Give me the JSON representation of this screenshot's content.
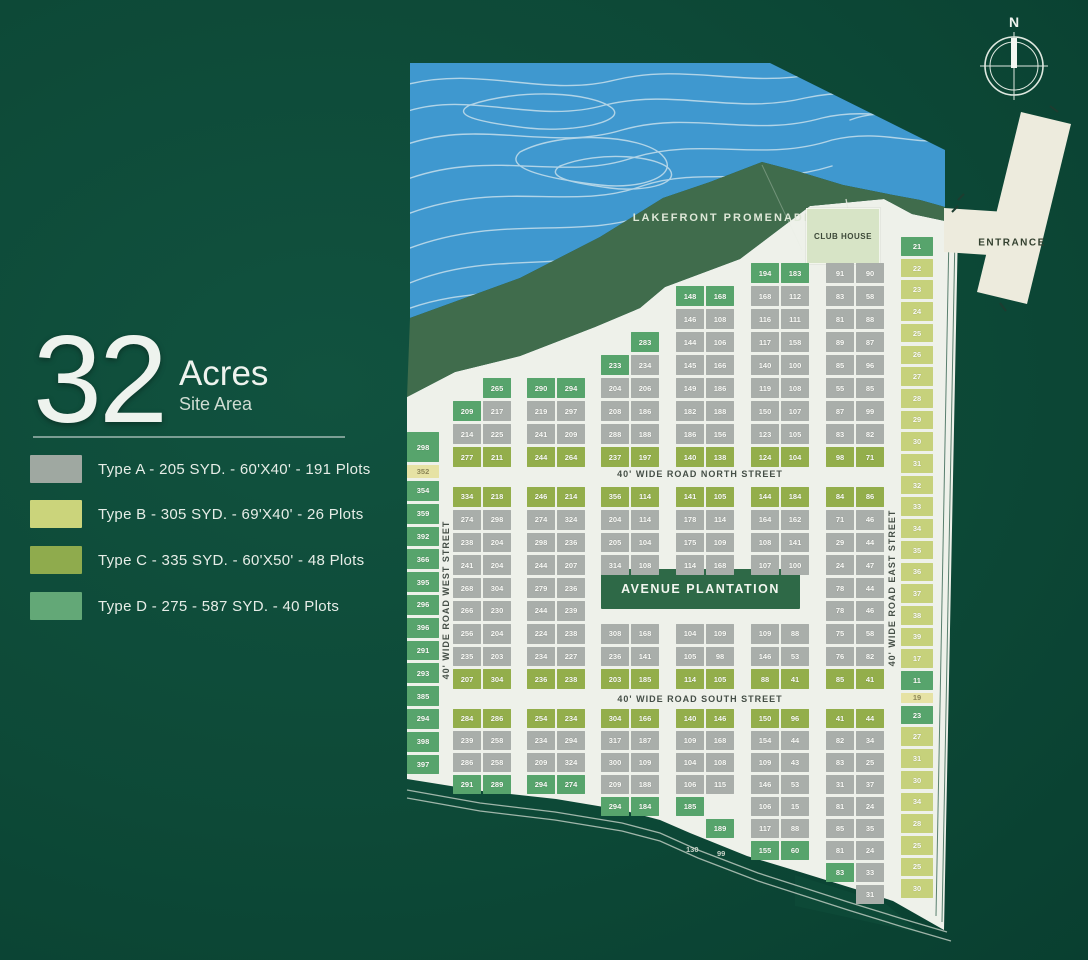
{
  "header": {
    "number": "32",
    "unit": "Acres",
    "subtitle": "Site Area"
  },
  "legend": {
    "items": [
      {
        "type": "A",
        "color": "#9fa8a1",
        "label": "Type A - 205 SYD. - 60'X40' - 191 Plots"
      },
      {
        "type": "B",
        "color": "#cbd47b",
        "label": "Type B - 305 SYD. - 69'X40' - 26 Plots"
      },
      {
        "type": "C",
        "color": "#8fab4d",
        "label": "Type C - 335 SYD. - 60'X50' - 48 Plots"
      },
      {
        "type": "D",
        "color": "#63a877",
        "label": "Type D - 275 - 587 SYD. - 40 Plots"
      }
    ]
  },
  "compass": {
    "label": "N"
  },
  "map": {
    "labels": {
      "promenade": "LAKEFRONT PROMENADE",
      "club_house": "CLUB HOUSE",
      "plantation": "AVENUE PLANTATION",
      "entrance": "ENTRANCE",
      "north_street": "40' WIDE ROAD NORTH STREET",
      "south_street": "40' WIDE ROAD SOUTH STREET",
      "west_street": "40' WIDE ROAD WEST STREET",
      "east_street": "40' WIDE ROAD EAST STREET"
    },
    "plot_colors": {
      "A": "#a9aeaa",
      "B": "#c6d17b",
      "C": "#93ae4b",
      "D": "#57a46c",
      "Y": "#e6e2a4"
    },
    "stray_labels": [
      {
        "x": 686,
        "y": 845,
        "t": "130"
      },
      {
        "x": 717,
        "y": 849,
        "t": "99"
      }
    ],
    "columns": [
      {
        "name": "west-plots",
        "x": 407,
        "w": 32,
        "top": 432,
        "cellH": 19.8,
        "cells": [
          {
            "t": "D",
            "n": "298",
            "h": 30
          },
          {
            "t": "Y",
            "n": "352",
            "h": 13
          },
          "D:354",
          "D:359",
          "D:392",
          "D:366",
          "D:395",
          "D:296",
          "D:396",
          "D:291",
          "D:293",
          "D:385",
          "D:294",
          "D:398",
          "D:397"
        ]
      },
      {
        "name": "east-plots",
        "x": 901,
        "w": 32,
        "top": 237,
        "cellH": 18.7,
        "cells": [
          "D:21",
          "B:22",
          "B:23",
          "B:24",
          "B:25",
          "B:26",
          "B:27",
          "B:28",
          "B:29",
          "B:30",
          "B:31",
          "B:32",
          "B:33",
          "B:34",
          "B:35",
          "B:36",
          "B:37",
          "B:38",
          "B:39",
          "B:17",
          {
            "t": "D",
            "n": "11"
          },
          {
            "t": "Y",
            "n": "19",
            "h": 10
          },
          {
            "t": "D",
            "n": "23"
          },
          "B:27",
          "B:31",
          "B:30",
          "B:34",
          "B:28",
          "B:25",
          "B:25",
          "B:30"
        ]
      }
    ],
    "sections": [
      {
        "name": "north",
        "pitch": 23,
        "cellH": 20,
        "blocks": [
          {
            "x": 453,
            "top": 378,
            "rows": [
              [
                null,
                "D:265"
              ],
              [
                "D:209",
                "A:217"
              ],
              [
                "A:214",
                "A:225"
              ],
              [
                "C:277",
                "C:211"
              ]
            ]
          },
          {
            "x": 527,
            "top": 378,
            "rows": [
              [
                "D:290",
                "D:294"
              ],
              [
                "A:219",
                "A:297"
              ],
              [
                "A:241",
                "A:209"
              ],
              [
                "C:244",
                "C:264"
              ]
            ]
          },
          {
            "x": 601,
            "top": 332,
            "rows": [
              [
                null,
                "D:283"
              ],
              [
                "D:233",
                "A:234"
              ],
              [
                "A:204",
                "A:206"
              ],
              [
                "A:208",
                "A:186"
              ],
              [
                "A:288",
                "A:188"
              ],
              [
                "C:237",
                "C:197"
              ]
            ]
          },
          {
            "x": 676,
            "top": 286,
            "rows": [
              [
                "D:148",
                "D:168"
              ],
              [
                "A:146",
                "A:108"
              ],
              [
                "A:144",
                "A:106"
              ],
              [
                "A:145",
                "A:166"
              ],
              [
                "A:149",
                "A:186"
              ],
              [
                "A:182",
                "A:188"
              ],
              [
                "A:186",
                "A:156"
              ],
              [
                "C:140",
                "C:138"
              ]
            ]
          },
          {
            "x": 751,
            "top": 263,
            "rows": [
              [
                "D:194",
                "D:183"
              ],
              [
                "A:168",
                "A:112"
              ],
              [
                "A:116",
                "A:111"
              ],
              [
                "A:117",
                "A:158"
              ],
              [
                "A:140",
                "A:100"
              ],
              [
                "A:119",
                "A:108"
              ],
              [
                "A:150",
                "A:107"
              ],
              [
                "A:123",
                "A:105"
              ],
              [
                "C:124",
                "C:104"
              ]
            ]
          },
          {
            "x": 826,
            "top": 263,
            "rows": [
              [
                "A:91",
                "A:90"
              ],
              [
                "A:83",
                "A:58"
              ],
              [
                "A:81",
                "A:88"
              ],
              [
                "A:89",
                "A:87"
              ],
              [
                "A:85",
                "A:96"
              ],
              [
                "A:55",
                "A:85"
              ],
              [
                "A:87",
                "A:99"
              ],
              [
                "A:83",
                "A:82"
              ],
              [
                "C:98",
                "C:71"
              ]
            ]
          }
        ]
      },
      {
        "name": "middle",
        "pitch": 22.8,
        "cellH": 19.8,
        "blocks": [
          {
            "x": 453,
            "top": 487,
            "rows": [
              [
                "C:334",
                "C:218"
              ],
              [
                "A:274",
                "A:298"
              ],
              [
                "A:238",
                "A:204"
              ],
              [
                "A:241",
                "A:204"
              ],
              [
                "A:268",
                "A:304"
              ],
              [
                "A:266",
                "A:230"
              ],
              [
                "A:256",
                "A:204"
              ],
              [
                "A:235",
                "A:203"
              ],
              [
                "C:207",
                "C:304"
              ]
            ]
          },
          {
            "x": 527,
            "top": 487,
            "rows": [
              [
                "C:246",
                "C:214"
              ],
              [
                "A:274",
                "A:324"
              ],
              [
                "A:298",
                "A:236"
              ],
              [
                "A:244",
                "A:207"
              ],
              [
                "A:279",
                "A:236"
              ],
              [
                "A:244",
                "A:239"
              ],
              [
                "A:224",
                "A:238"
              ],
              [
                "A:234",
                "A:227"
              ],
              [
                "C:236",
                "C:238"
              ]
            ]
          },
          {
            "x": 601,
            "top": 487,
            "rows": [
              [
                "C:356",
                "C:114"
              ],
              [
                "A:204",
                "A:114"
              ],
              [
                "A:205",
                "A:104"
              ],
              [
                "A:314",
                "A:108"
              ],
              null,
              null,
              [
                "A:308",
                "A:168"
              ],
              [
                "A:236",
                "A:141"
              ],
              [
                "C:203",
                "C:185"
              ]
            ]
          },
          {
            "x": 676,
            "top": 487,
            "rows": [
              [
                "C:141",
                "C:105"
              ],
              [
                "A:178",
                "A:114"
              ],
              [
                "A:175",
                "A:109"
              ],
              [
                "A:114",
                "A:168"
              ],
              null,
              null,
              [
                "A:104",
                "A:109"
              ],
              [
                "A:105",
                "A:98"
              ],
              [
                "C:114",
                "C:105"
              ]
            ]
          },
          {
            "x": 751,
            "top": 487,
            "rows": [
              [
                "C:144",
                "C:184"
              ],
              [
                "A:164",
                "A:162"
              ],
              [
                "A:108",
                "A:141"
              ],
              [
                "A:107",
                "A:100"
              ],
              null,
              null,
              [
                "A:109",
                "A:88"
              ],
              [
                "A:146",
                "A:53"
              ],
              [
                "C:88",
                "C:41"
              ]
            ]
          },
          {
            "x": 826,
            "top": 487,
            "rows": [
              [
                "C:84",
                "C:86"
              ],
              [
                "A:71",
                "A:46"
              ],
              [
                "A:29",
                "A:44"
              ],
              [
                "A:24",
                "A:47"
              ],
              [
                "A:78",
                "A:44"
              ],
              [
                "A:78",
                "A:46"
              ],
              [
                "A:75",
                "A:58"
              ],
              [
                "A:76",
                "A:82"
              ],
              [
                "C:85",
                "C:41"
              ]
            ]
          }
        ]
      },
      {
        "name": "south",
        "pitch": 22,
        "cellH": 19,
        "blocks": [
          {
            "x": 453,
            "top": 709,
            "rows": [
              [
                "C:284",
                "C:286"
              ],
              [
                "A:239",
                "A:258"
              ],
              [
                "A:286",
                "A:258"
              ],
              [
                "D:291",
                "D:289"
              ]
            ]
          },
          {
            "x": 527,
            "top": 709,
            "rows": [
              [
                "C:254",
                "C:234"
              ],
              [
                "A:234",
                "A:294"
              ],
              [
                "A:209",
                "A:324"
              ],
              [
                "D:294",
                "D:274"
              ]
            ]
          },
          {
            "x": 601,
            "top": 709,
            "rows": [
              [
                "C:304",
                "C:166"
              ],
              [
                "A:317",
                "A:187"
              ],
              [
                "A:300",
                "A:109"
              ],
              [
                "A:209",
                "A:188"
              ],
              [
                "D:294",
                "D:184"
              ]
            ]
          },
          {
            "x": 676,
            "top": 709,
            "rows": [
              [
                "C:140",
                "C:146"
              ],
              [
                "A:109",
                "A:168"
              ],
              [
                "A:104",
                "A:108"
              ],
              [
                "A:106",
                "A:115"
              ],
              [
                "D:185",
                null
              ],
              [
                null,
                "D:189"
              ]
            ]
          },
          {
            "x": 751,
            "top": 709,
            "rows": [
              [
                "C:150",
                "C:96"
              ],
              [
                "A:154",
                "A:44"
              ],
              [
                "A:109",
                "A:43"
              ],
              [
                "A:146",
                "A:53"
              ],
              [
                "A:106",
                "A:15"
              ],
              [
                "A:117",
                "A:88"
              ],
              [
                "D:155",
                "D:60"
              ]
            ]
          },
          {
            "x": 826,
            "top": 709,
            "rows": [
              [
                "C:41",
                "C:44"
              ],
              [
                "A:82",
                "A:34"
              ],
              [
                "A:83",
                "A:25"
              ],
              [
                "A:31",
                "A:37"
              ],
              [
                "A:81",
                "A:24"
              ],
              [
                "A:85",
                "A:35"
              ],
              [
                "A:81",
                "A:24"
              ],
              [
                "D:83",
                "A:33"
              ],
              [
                null,
                "A:31"
              ]
            ]
          }
        ]
      }
    ]
  }
}
